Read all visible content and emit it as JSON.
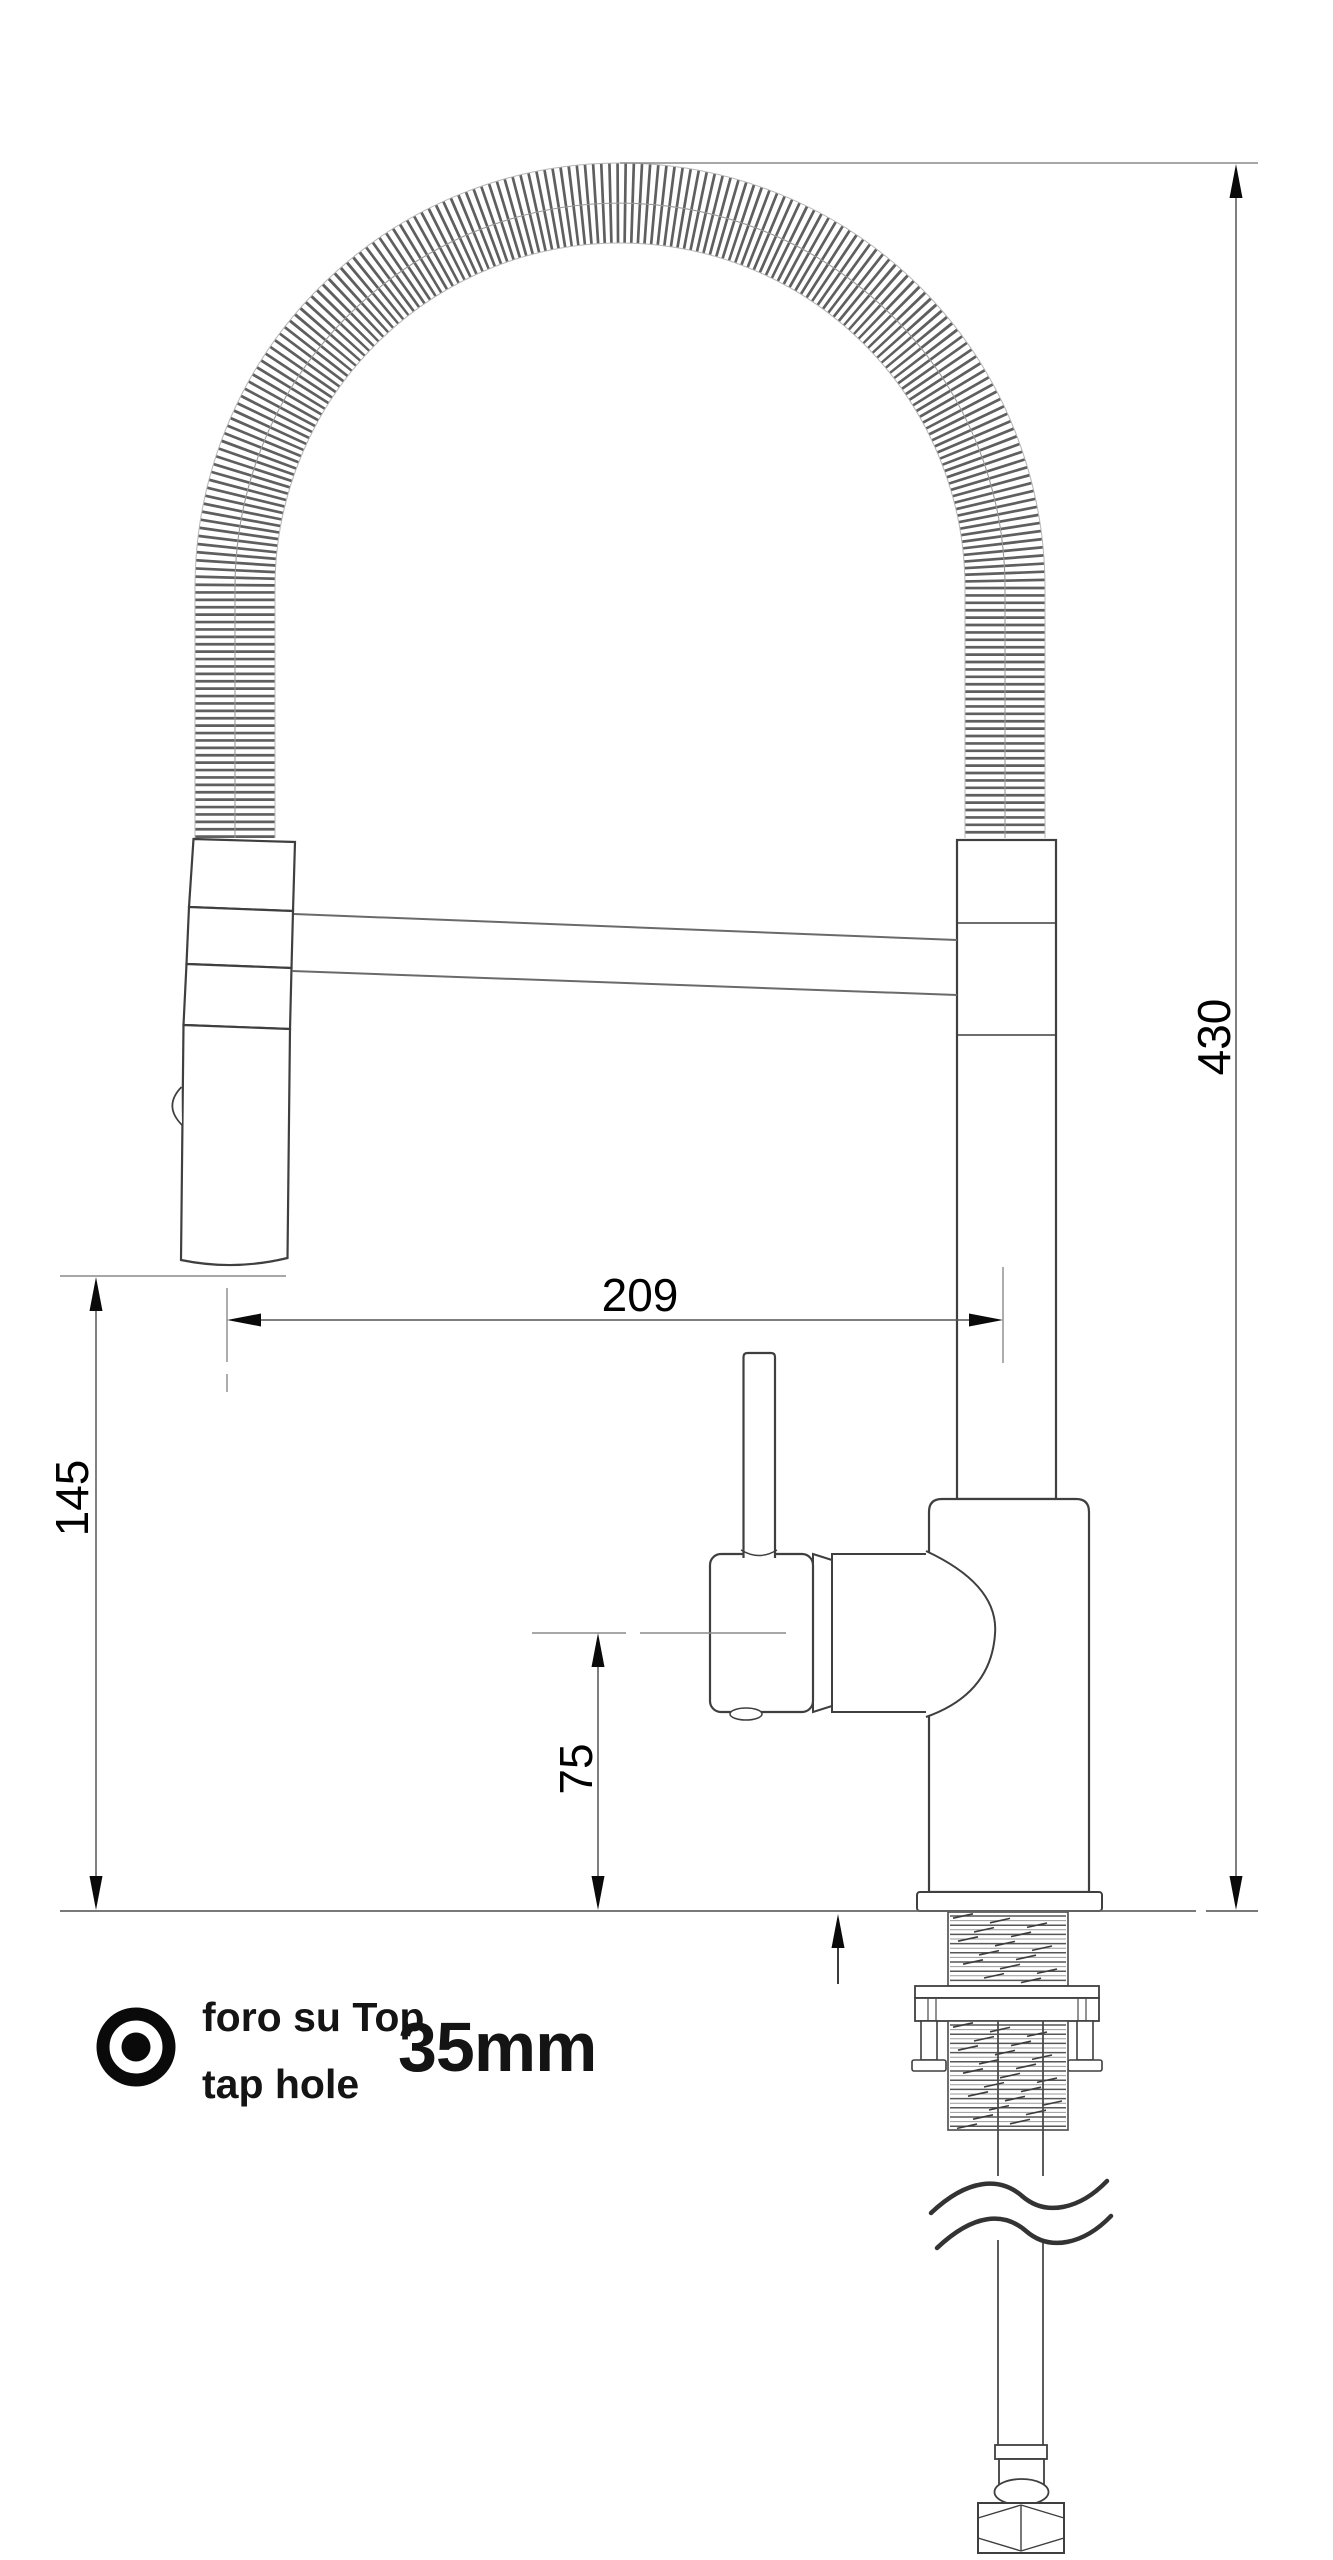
{
  "drawing": {
    "title": "kitchen faucet installation drawing",
    "view": "side elevation with spring pull-down spout",
    "unit": "mm"
  },
  "dimensions": {
    "overall_height": "430",
    "spout_reach": "209",
    "spray_head_height": "145",
    "body_height": "75"
  },
  "note": {
    "line1_it": "foro su Top",
    "line2_en": "tap hole",
    "hole_size": "35mm"
  },
  "icons": {
    "tap_hole": "bullseye-icon"
  },
  "colors": {
    "background": "#ffffff",
    "outline": "#3f3f3f",
    "dimension_line": "#555555",
    "extension_line": "#8a8a8a",
    "text": "#000000"
  }
}
